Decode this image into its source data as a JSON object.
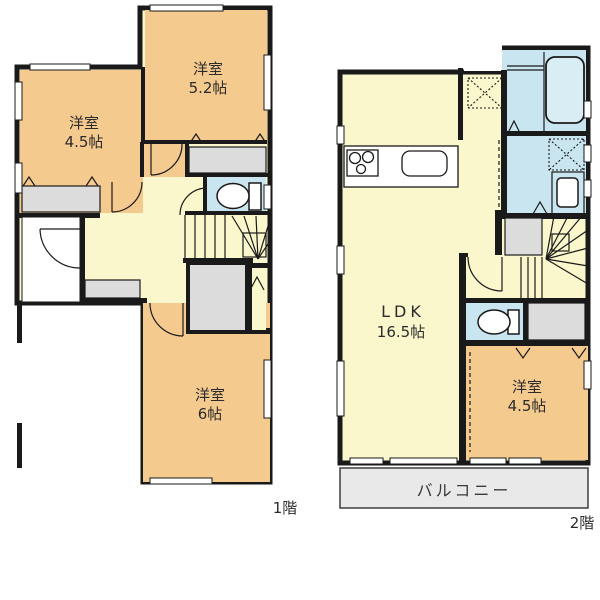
{
  "floor1": {
    "floor_label": "1階",
    "room_52": {
      "name": "洋室",
      "area": "5.2帖"
    },
    "room_45": {
      "name": "洋室",
      "area": "4.5帖"
    },
    "room_6": {
      "name": "洋室",
      "area": "6帖"
    }
  },
  "floor2": {
    "floor_label": "2階",
    "ldk": {
      "name": "LDK",
      "area": "16.5帖"
    },
    "room_45": {
      "name": "洋室",
      "area": "4.5帖"
    },
    "balcony_label": "バルコニー"
  },
  "colors": {
    "wall": "#1a1a1a",
    "room_orange": "#f5ca8e",
    "hall_yellow": "#faf7cc",
    "wet_blue": "#c9e5ef",
    "closet_gray": "#dcdcdc",
    "balcony_gray": "#e9e9e9",
    "tub_blue": "#d9edf4"
  }
}
